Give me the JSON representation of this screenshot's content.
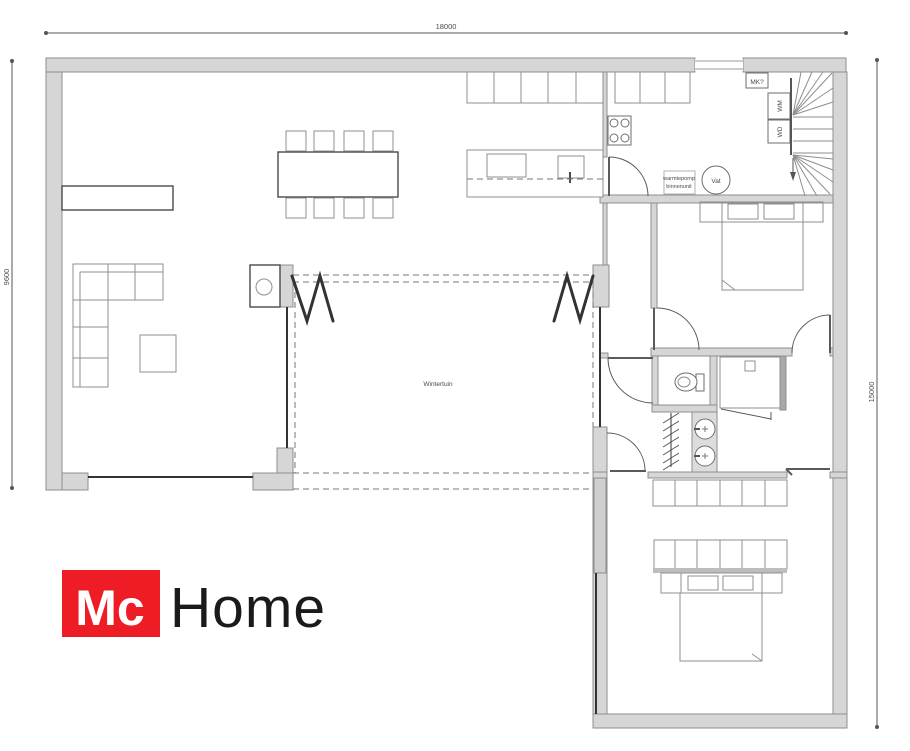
{
  "colors": {
    "wall": "#d6d6d6",
    "wallStroke": "#8f8f8f",
    "wallDark": "#a8a8a8",
    "windowPane": "#cfcfcf",
    "bar": "#bdbdbd",
    "vanity": "#dcdcdc",
    "furn": "#8f8f8f",
    "dark": "#333333",
    "dashline": "#777777",
    "doorline": "#5a5a5a",
    "dim": "#555555",
    "text": "#4a4a4a",
    "red": "#ee1c25",
    "logoText": "#1a1a1a"
  },
  "dimensions": {
    "top": "18000",
    "left": "9600",
    "right": "15000"
  },
  "rooms": {
    "wintertuin": "Wintertuin"
  },
  "labels": {
    "mk": "MK?",
    "wm": "WM",
    "wd": "WD",
    "vat": "Vat",
    "heatpump_line1": "warmtepomp",
    "heatpump_line2": "binnenunit"
  },
  "logo": {
    "mc": "Mc",
    "home": "Home"
  }
}
